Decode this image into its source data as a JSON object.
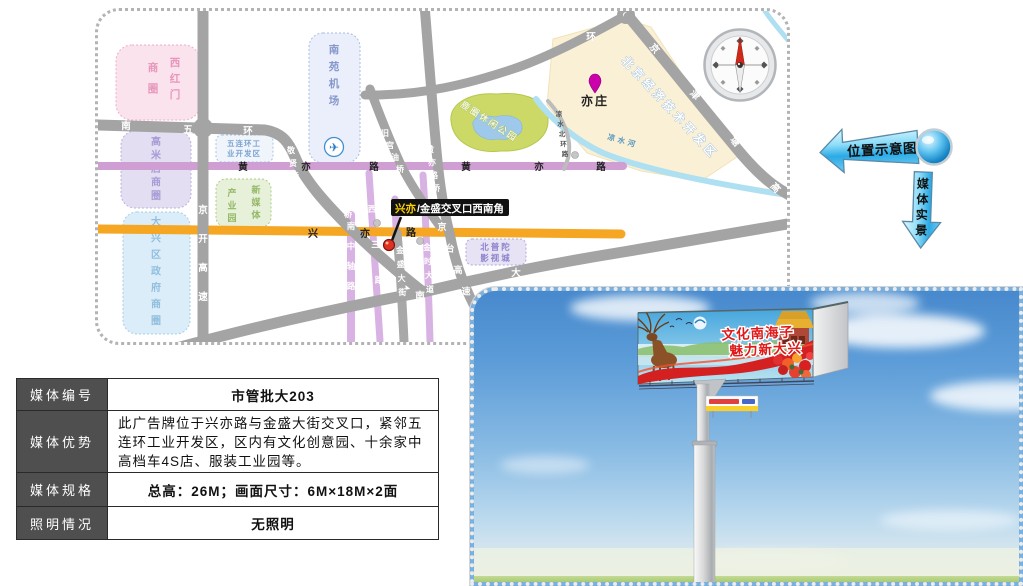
{
  "side_labels": {
    "location_arrow": "位置示意图",
    "photo_arrow": "媒体实景"
  },
  "map": {
    "regions": {
      "xihongmen_right": "西红门",
      "xihongmen_left": "商圈",
      "gaomidian": "高米店商圈",
      "daxing_gov": "大兴区政府商圈",
      "nanyuan_airport": "南苑机场",
      "industry_line1": "五连环工",
      "industry_line2": "业开发区",
      "new_media_right": "新媒体",
      "new_media_left": "产业园",
      "beiputuo_line1": "北普陀",
      "beiputuo_line2": "影视城",
      "etdz": "北京经济技术开发区",
      "park": "鹿圈休闲公园"
    },
    "roads": {
      "wuhuan_chars": [
        "南",
        "五",
        "环"
      ],
      "huangyi_west": [
        "黄",
        "亦",
        "路"
      ],
      "huangyi_east": [
        "黄",
        "亦",
        "路"
      ],
      "xingyi_chars": [
        "兴",
        "亦",
        "路"
      ],
      "jingkai": "京开高速",
      "jingtai": "京台高速",
      "nanzhongzhou": "南中轴路",
      "xisan": "西三路",
      "jinsheng": "金盛大街",
      "jinshi": "金时大道",
      "jingxian_bridge": "敬贤桥",
      "zhiyuanxi_bridge": "致远西桥",
      "huangyilu_bridge": "黄亦路桥",
      "jiugongyou_bridge": "旧宫油桥",
      "jingjintang": "京津塘高速",
      "liangshui_beihuan": "凉水北环路",
      "huan_char": "环",
      "nan_char": "南",
      "da_char": "大"
    },
    "river": "凉水河",
    "poi_yizhuang": "亦庄",
    "marker": {
      "highlight": "兴亦",
      "rest": "/金盛交叉口西南角"
    }
  },
  "table": {
    "rows": [
      {
        "label": "媒体编号",
        "value": "市管批大203"
      },
      {
        "label": "媒体优势",
        "value": "此广告牌位于兴亦路与金盛大街交叉口，紧邻五连环工业开发区，区内有文化创意园、十余家中高档车4S店、服装工业园等。"
      },
      {
        "label": "媒体规格",
        "value": "总高：26M；画面尺寸：6M×18M×2面"
      },
      {
        "label": "照明情况",
        "value": "无照明"
      }
    ]
  },
  "billboard": {
    "ad_line1": "文化南海子",
    "ad_line2": "魅力新大兴"
  }
}
